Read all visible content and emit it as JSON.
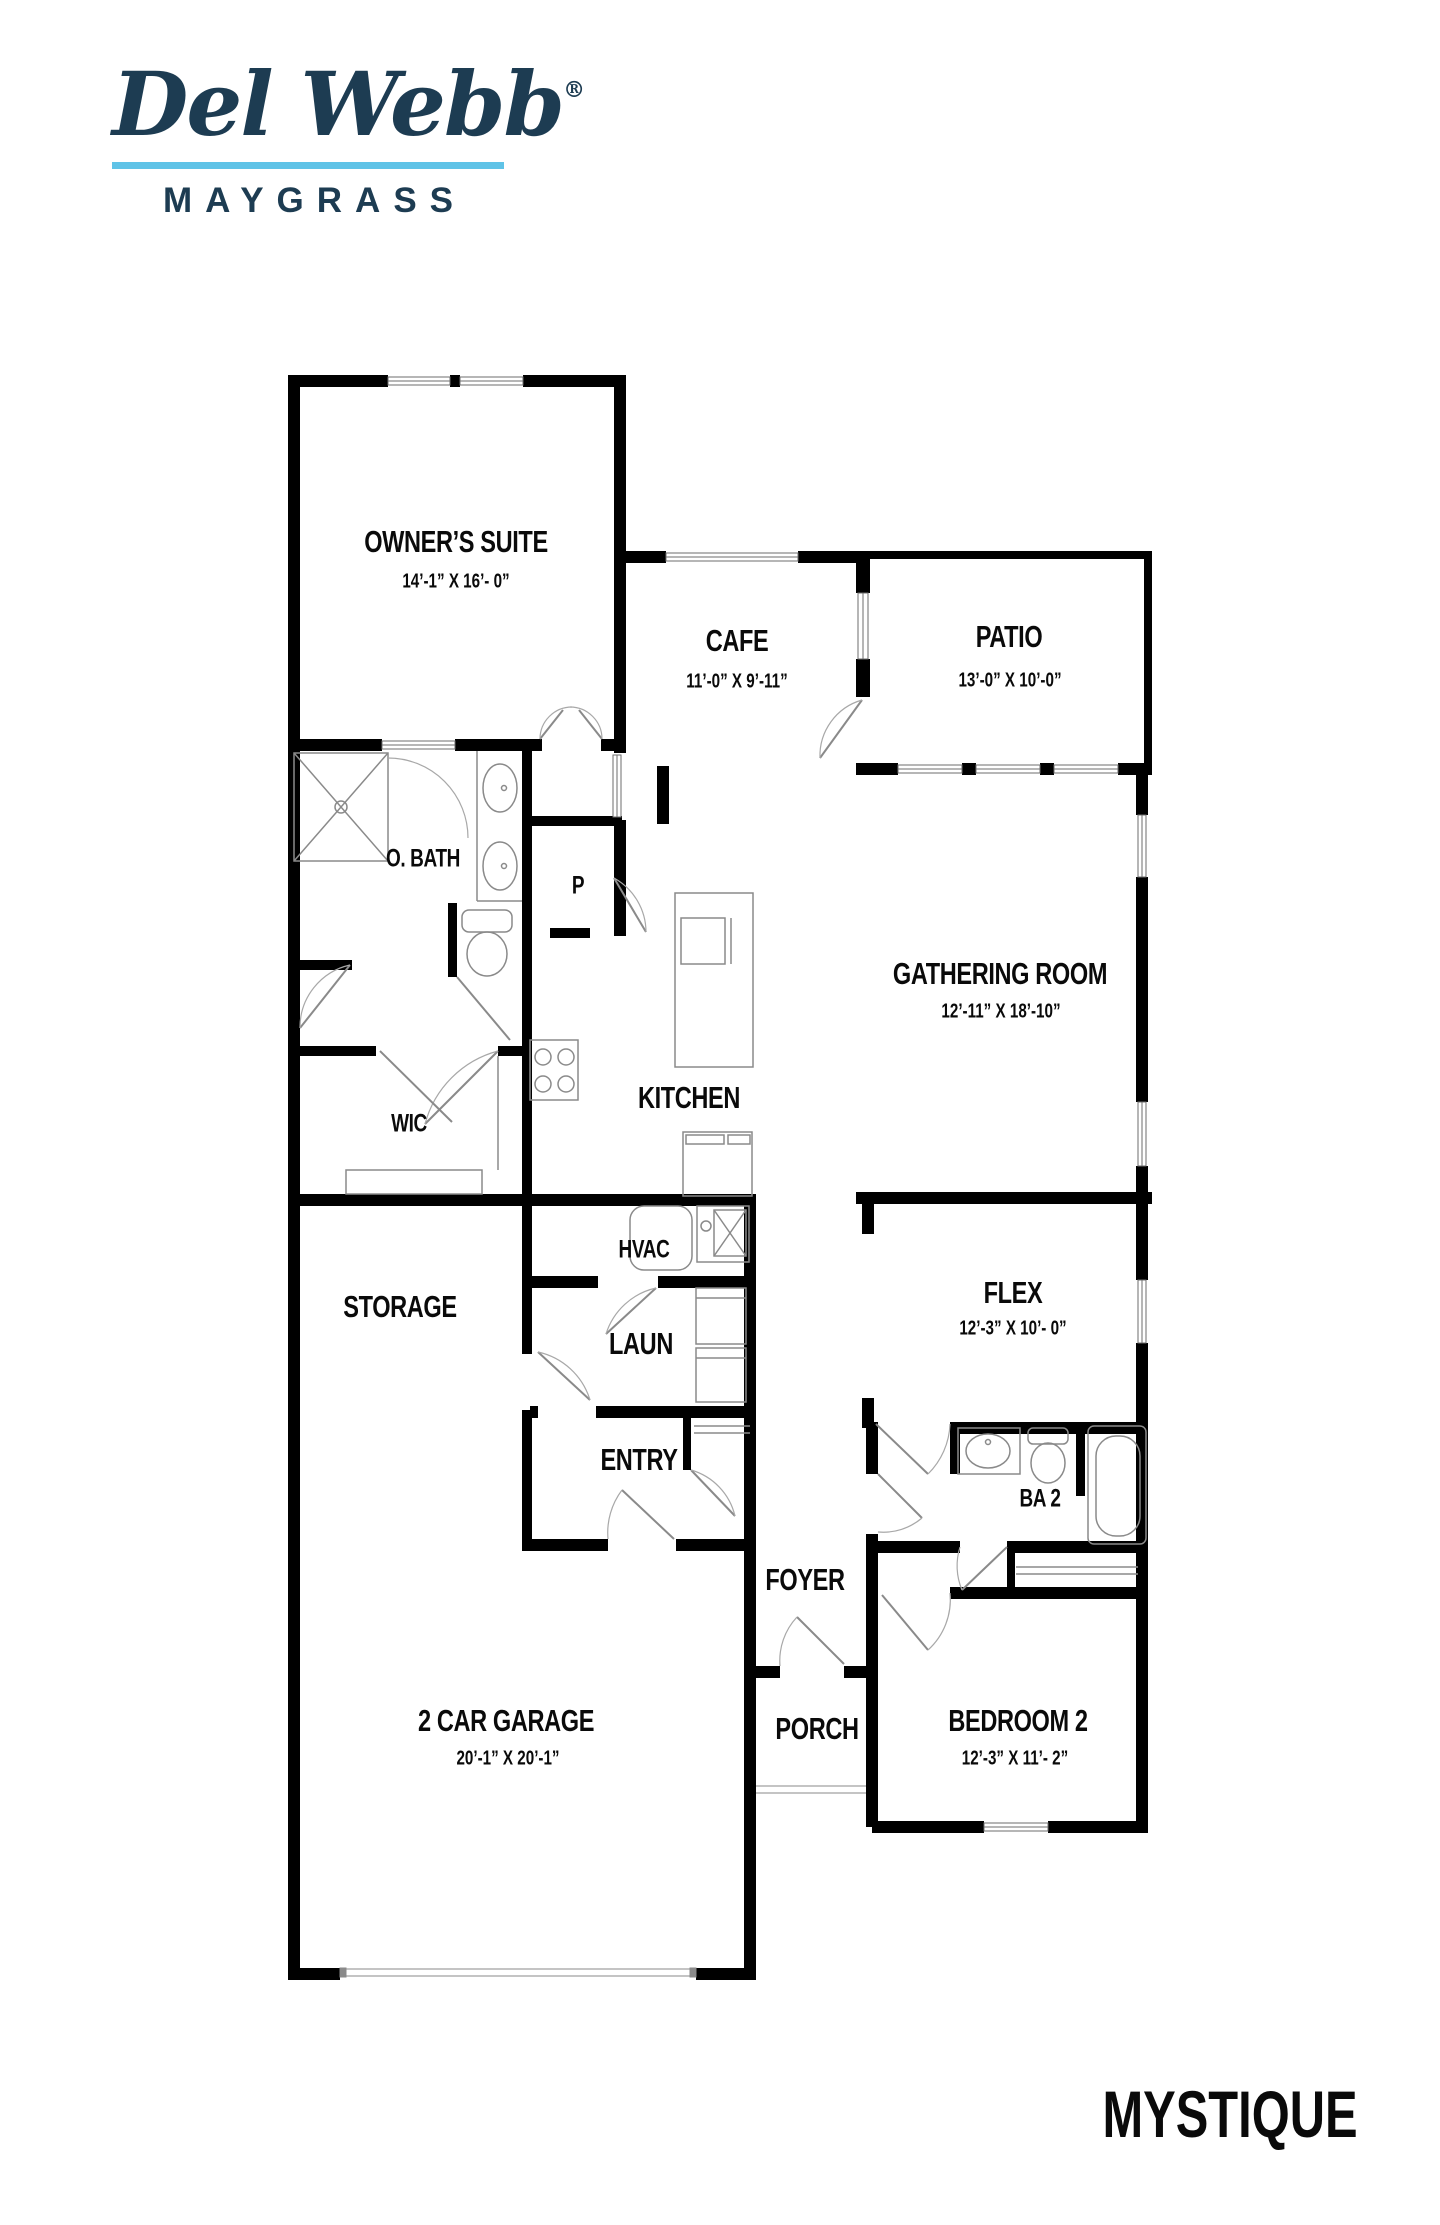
{
  "brand": {
    "name": "Del Webb",
    "registered": "®",
    "community": "MAYGRASS"
  },
  "plan_name": "MYSTIQUE",
  "colors": {
    "logo_navy": "#1d3c52",
    "logo_underline": "#5fc3e7",
    "walls": "#000000",
    "fixture_lines": "#8a8a8a"
  },
  "rooms": {
    "owners_suite": {
      "name": "OWNER’S SUITE",
      "dims": "14’-1” X 16’- 0”"
    },
    "cafe": {
      "name": "CAFE",
      "dims": "11’-0” X 9’-11”"
    },
    "patio": {
      "name": "PATIO",
      "dims": "13’-0” X 10’-0”"
    },
    "gathering": {
      "name": "GATHERING ROOM",
      "dims": "12’-11” X 18’-10”"
    },
    "obath": {
      "name": "O. BATH"
    },
    "pantry": {
      "name": "P"
    },
    "kitchen": {
      "name": "KITCHEN"
    },
    "wic": {
      "name": "WIC"
    },
    "hvac": {
      "name": "HVAC"
    },
    "storage": {
      "name": "STORAGE"
    },
    "laundry": {
      "name": "LAUN"
    },
    "flex": {
      "name": "FLEX",
      "dims": "12’-3” X 10’- 0”"
    },
    "entry": {
      "name": "ENTRY"
    },
    "ba2": {
      "name": "BA 2"
    },
    "foyer": {
      "name": "FOYER"
    },
    "porch": {
      "name": "PORCH"
    },
    "garage": {
      "name": "2 CAR GARAGE",
      "dims": "20’-1” X 20’-1”"
    },
    "bedroom2": {
      "name": "BEDROOM 2",
      "dims": "12’-3” X 11’- 2”"
    }
  }
}
